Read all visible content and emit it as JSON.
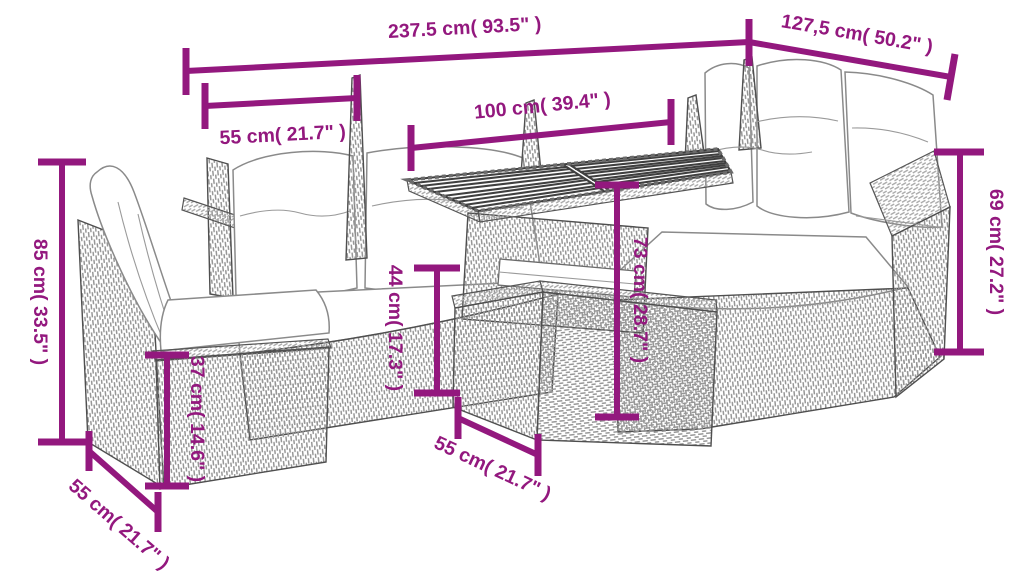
{
  "diagram": {
    "kind": "product-dimension-diagram",
    "subject": "poly rattan corner sofa set with cushions, slatted-top table and chair",
    "style": {
      "accent_color": "#93187E",
      "line_art_color": "#555555",
      "background": "#FFFFFF"
    },
    "dimensions": [
      {
        "id": "total-width",
        "label": "237.5 cm( 93.5\" )",
        "orientation": "horizontal"
      },
      {
        "id": "corner-depth",
        "label": "127,5 cm( 50.2\" )",
        "orientation": "diagonal"
      },
      {
        "id": "back-cushion-width",
        "label": "55 cm( 21.7\" )",
        "orientation": "horizontal"
      },
      {
        "id": "table-length",
        "label": "100 cm( 39.4\" )",
        "orientation": "horizontal"
      },
      {
        "id": "chair-back-height",
        "label": "85 cm( 33.5\" )",
        "orientation": "vertical"
      },
      {
        "id": "sofa-back-height",
        "label": "69 cm( 27.2\" )",
        "orientation": "vertical"
      },
      {
        "id": "seat-height",
        "label": "44 cm( 17.3\" )",
        "orientation": "vertical"
      },
      {
        "id": "table-height",
        "label": "73 cm( 28.7\" )",
        "orientation": "vertical"
      },
      {
        "id": "stool-height",
        "label": "37 cm( 14.6\" )",
        "orientation": "vertical"
      },
      {
        "id": "table-depth",
        "label": "55 cm( 21.7\" )",
        "orientation": "diagonal"
      },
      {
        "id": "stool-depth",
        "label": "55 cm( 21.7\" )",
        "orientation": "diagonal"
      }
    ]
  }
}
